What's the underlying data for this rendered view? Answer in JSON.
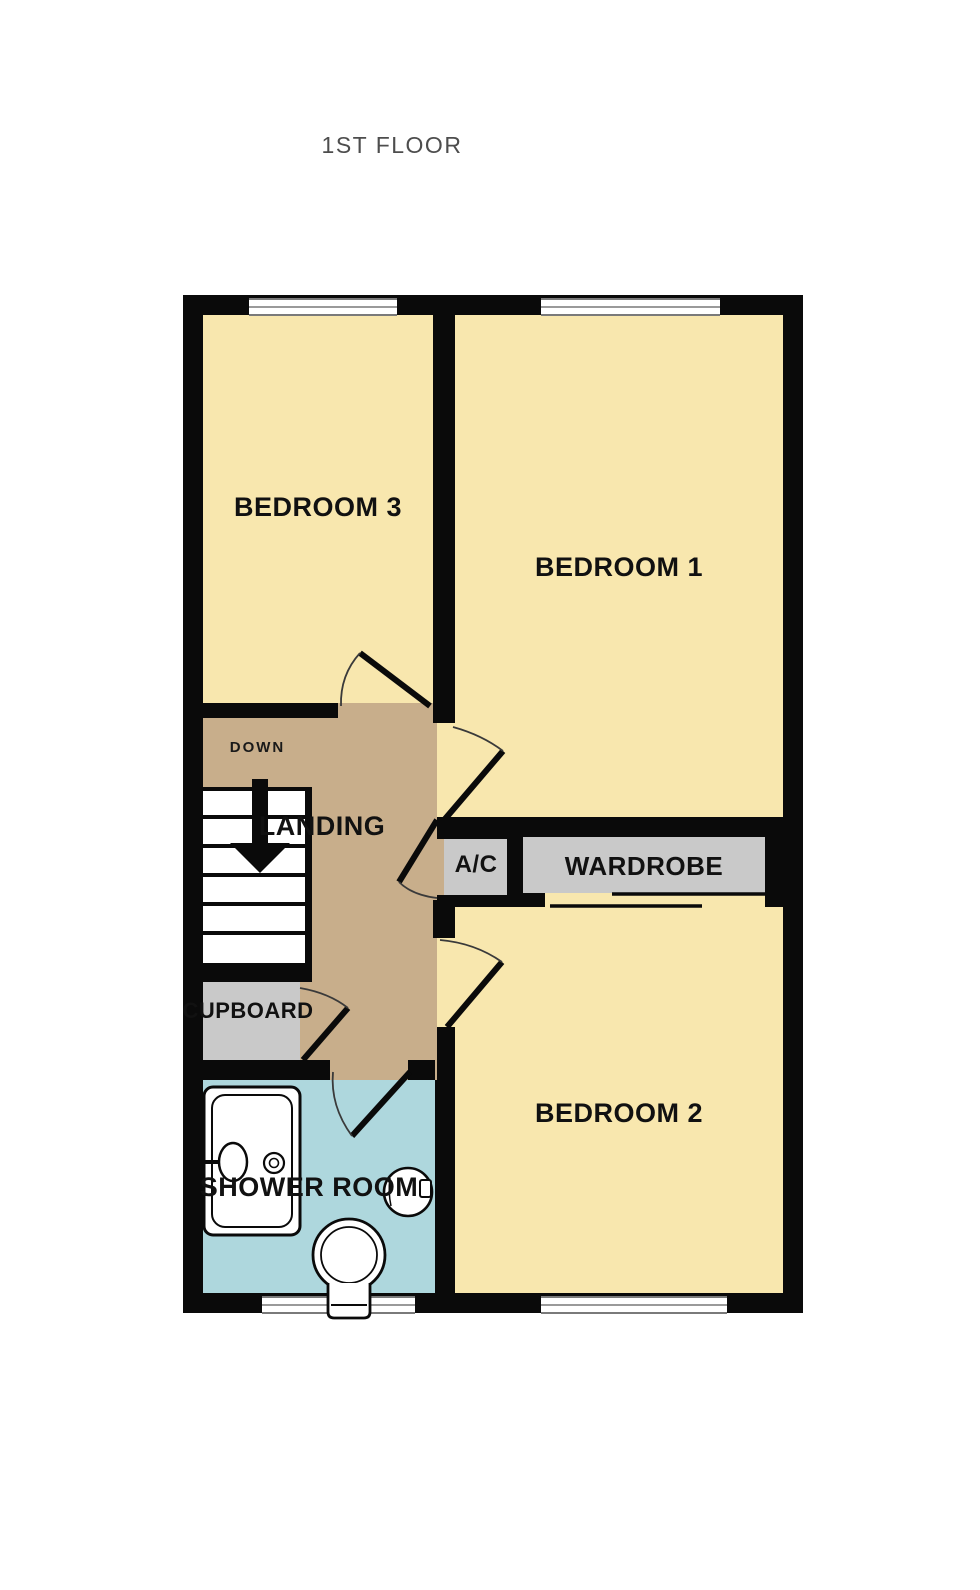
{
  "title": "1ST FLOOR",
  "floorplan": {
    "rooms": [
      {
        "id": "bedroom-3",
        "label": "BEDROOM 3",
        "fill": "#F8E7AE"
      },
      {
        "id": "bedroom-1",
        "label": "BEDROOM 1",
        "fill": "#F8E7AE"
      },
      {
        "id": "landing",
        "label": "LANDING",
        "fill": "#C8AE8B"
      },
      {
        "id": "ac",
        "label": "A/C",
        "fill": "#C9C9C9"
      },
      {
        "id": "wardrobe",
        "label": "WARDROBE",
        "fill": "#C9C9C9"
      },
      {
        "id": "cupboard",
        "label": "CUPBOARD",
        "fill": "#C9C9C9"
      },
      {
        "id": "shower-room",
        "label": "SHOWER ROOM",
        "fill": "#AED7DD"
      },
      {
        "id": "bedroom-2",
        "label": "BEDROOM 2",
        "fill": "#F8E7AE"
      }
    ],
    "stairs": {
      "label": "DOWN",
      "direction": "down"
    },
    "fixtures": [
      "shower-tray",
      "washbasin",
      "toilet"
    ],
    "colors": {
      "wall": "#0a0a0a",
      "room_fill": "#F8E7AE",
      "hall_fill": "#C8AE8B",
      "bath_fill": "#AED7DD",
      "storage_fill": "#C9C9C9",
      "title_text": "#4d4d4d",
      "label_text": "#111111"
    }
  }
}
